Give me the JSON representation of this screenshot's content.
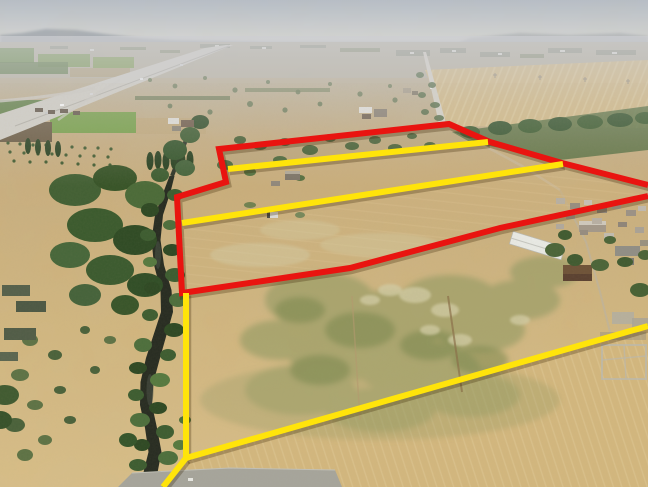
{
  "meta": {
    "kind": "aerial-drone-photograph",
    "description": "Aerial photo of dry farmland with red and yellow property-boundary lines drawn over it; tree-lined river on the left, highway and hazy horizon in the distance, farm buildings and a village to the right",
    "width": 648,
    "height": 487
  },
  "overlay": {
    "red_color": "#e91410",
    "yellow_color": "#ffe40a",
    "line_width": 6,
    "shadow_color": "rgba(55,32,0,0.28)",
    "shadow_width": 7.5,
    "red_boundary": {
      "label": "red outer boundary",
      "points": "648,185 562,163 490,142 449,124 219,149 226,182 177,197 182,293 350,268 500,228 648,196"
    },
    "yellow_top": {
      "label": "yellow subdivision line top",
      "points": "228,169 488,142"
    },
    "yellow_middle": {
      "label": "yellow subdivision line middle",
      "points": "182,223 563,164"
    },
    "yellow_left_vertical": {
      "label": "yellow west boundary",
      "points": "186,293 186,458"
    },
    "yellow_bottom_diagonal": {
      "label": "yellow south-east boundary",
      "points": "186,458 648,326"
    },
    "yellow_bottom_left": {
      "label": "yellow south-west spur",
      "points": "186,458 163,487"
    }
  },
  "scene": {
    "sky_top": "#b6bdc7",
    "sky_horizon": "#d8d8d5",
    "haze": "#cdced2",
    "hills": "#9fa5ad",
    "land_far": "#b8b2a2",
    "land_mid": "#c6ab7c",
    "land_near": "#d9be87",
    "green_patch": "#8a9760",
    "river_water": "#262b21",
    "tree_dark": "#33552c",
    "tree_mid": "#4a6b3a",
    "road_gray": "#d3d0c8",
    "bottom_road_gray": "#a6a59c"
  }
}
